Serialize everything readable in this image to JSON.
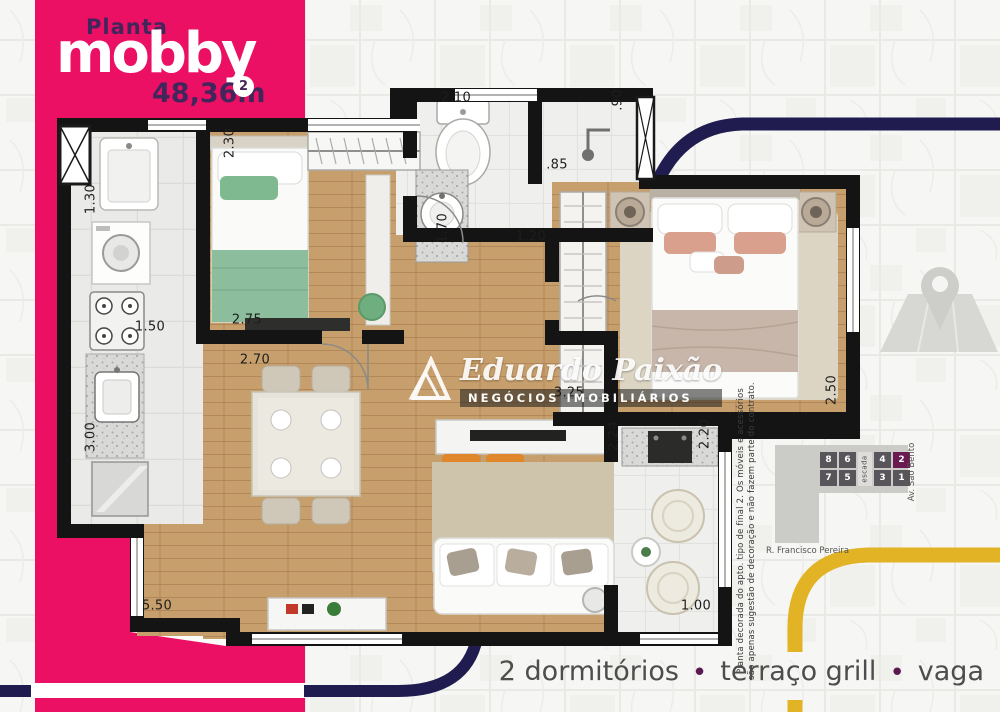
{
  "brand": {
    "kicker": "Planta",
    "name": "mobby",
    "area": "48,36m",
    "area_exp": "2"
  },
  "watermark": {
    "name": "Eduardo Paixão",
    "subtitle": "NEGÓCIOS IMOBILIÁRIOS"
  },
  "dims": [
    "2.30",
    "2.10",
    ".90",
    ".85",
    "1.70",
    "1.20",
    "1.30",
    "1.50",
    "2.75",
    "2.70",
    "3.00",
    "5.50",
    "3.25",
    "2.24",
    "2.20",
    "2.50",
    "1.00"
  ],
  "disclaimer": {
    "line1": "Planta decorada do apto. tipo de final 2. Os móveis e acessórios",
    "line2": "são apenas sugestão de decoração e não fazem parte do contrato."
  },
  "keyplan": {
    "row_top": [
      "8",
      "6",
      "4",
      "2"
    ],
    "row_bottom": [
      "7",
      "5",
      "3",
      "1"
    ],
    "stairs_label": "escada",
    "highlight_unit": "2",
    "street_side": "Av. São Bento",
    "street_bottom": "R. Francisco Pereira"
  },
  "footer": {
    "items": [
      "2 dormitórios",
      "terraço grill",
      "vaga"
    ],
    "bullet": "•"
  },
  "colors": {
    "pink": "#EC1065",
    "purple": "#41265B",
    "navy": "#201C4F",
    "yellow": "#E2B324",
    "keyplan_highlight": "#6B1A51",
    "tagline": "#4D4D4D"
  }
}
